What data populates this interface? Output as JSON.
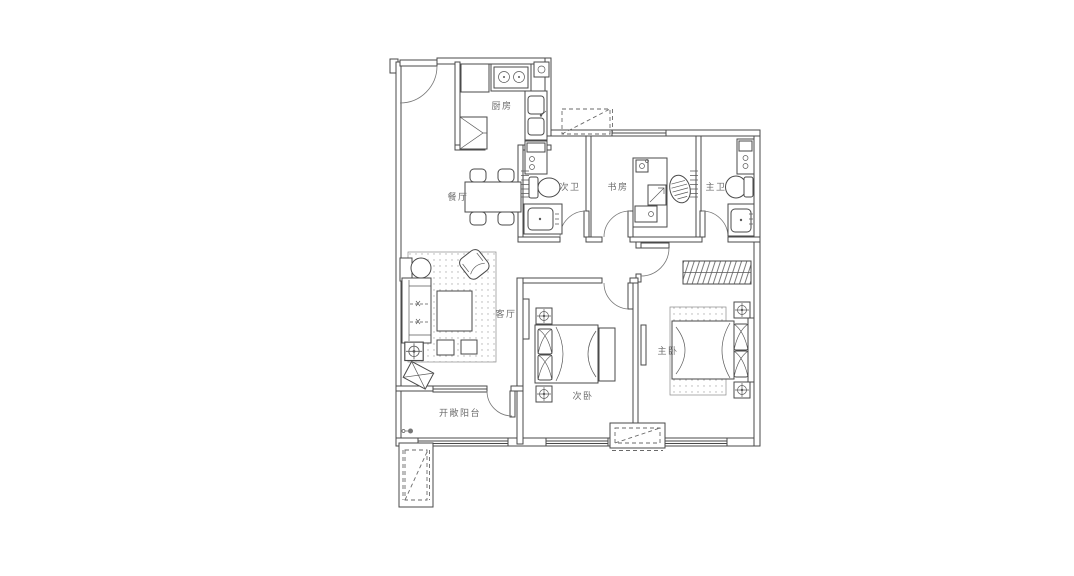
{
  "floorplan": {
    "background": "#ffffff",
    "line_color": "#4a4a4a",
    "label_color": "#6b6b6b",
    "rooms": {
      "kitchen": {
        "label": "厨房"
      },
      "dining": {
        "label": "餐厅"
      },
      "guest_bath": {
        "label": "次卫"
      },
      "study": {
        "label": "书房"
      },
      "master_bath": {
        "label": "主卫"
      },
      "living": {
        "label": "客厅"
      },
      "second_bedroom": {
        "label": "次卧"
      },
      "master_bedroom": {
        "label": "主卧"
      },
      "balcony": {
        "label": "开敞阳台"
      }
    }
  }
}
